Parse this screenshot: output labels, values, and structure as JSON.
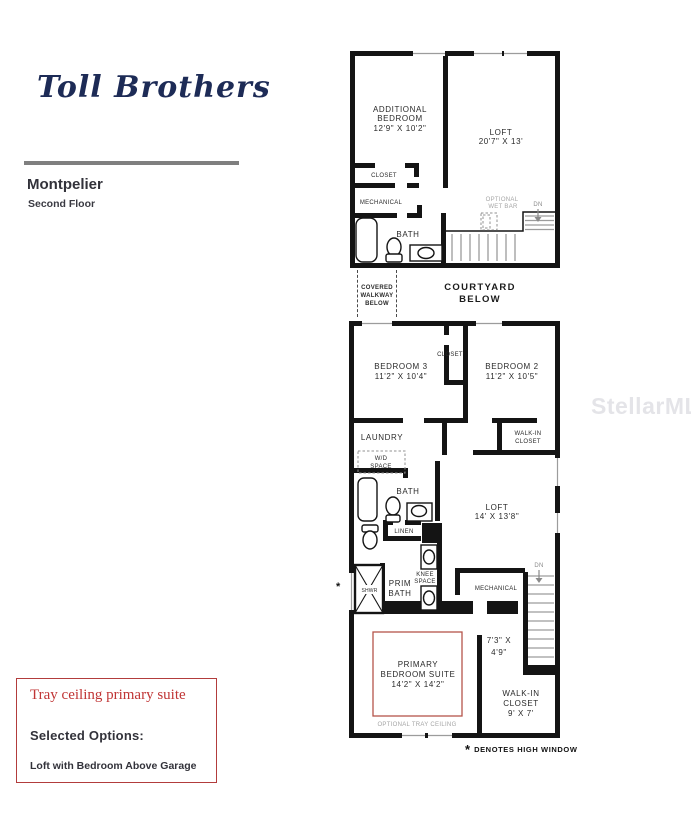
{
  "colors": {
    "logo_navy": "#1d2b56",
    "rule_gray": "#7f7f7f",
    "plan_ink": "#141414",
    "optional_gray": "#a5a5a5",
    "tray_red": "#b5544a",
    "box_border_red": "#b23c3c",
    "box_text_red": "#c03535",
    "watermark_gray": "#b8b8c2"
  },
  "brand": {
    "logo_text": "Toll Brothers"
  },
  "header": {
    "plan_name": "Montpelier",
    "floor_label": "Second Floor"
  },
  "watermark": {
    "text": "StellarMLS"
  },
  "upper_plan": {
    "additional_bedroom_1": "ADDITIONAL",
    "additional_bedroom_2": "BEDROOM",
    "additional_bedroom_dims": "12'9\" X 10'2\"",
    "loft": "LOFT",
    "loft_dims": "20'7\" X 13'",
    "closet": "CLOSET",
    "mechanical": "MECHANICAL",
    "bath": "BATH",
    "wet_bar_1": "OPTIONAL",
    "wet_bar_2": "WET BAR",
    "dn": "DN"
  },
  "courtyard": {
    "covered_1": "COVERED",
    "covered_2": "WALKWAY",
    "covered_3": "BELOW",
    "courtyard_1": "COURTYARD",
    "courtyard_2": "BELOW"
  },
  "lower_plan": {
    "bedroom3": "BEDROOM 3",
    "bedroom3_dims": "11'2\" X 10'4\"",
    "closet": "CLOSET",
    "bedroom2": "BEDROOM 2",
    "bedroom2_dims": "11'2\" X 10'5\"",
    "laundry": "LAUNDRY",
    "wd_1": "W/D",
    "wd_2": "SPACE",
    "walkin_top_1": "WALK-IN",
    "walkin_top_2": "CLOSET",
    "bath": "BATH",
    "linen": "LINEN",
    "loft": "LOFT",
    "loft_dims": "14' X 13'8\"",
    "knee_1": "KNEE",
    "knee_2": "SPACE",
    "prim_1": "PRIM",
    "prim_2": "BATH",
    "shwr": "SHWR",
    "mechanical": "MECHANICAL",
    "dn": "DN",
    "stair_hall_dims_1": "7'3\" X",
    "stair_hall_dims_2": "4'9\"",
    "primary_1": "PRIMARY",
    "primary_2": "BEDROOM SUITE",
    "primary_dims": "14'2\" X 14'2\"",
    "tray_note": "OPTIONAL TRAY CEILING",
    "high_window_star": "*"
  },
  "footnote": {
    "star": "*",
    "text": "DENOTES HIGH WINDOW"
  },
  "lower_walkin": {
    "l1": "WALK-IN",
    "l2": "CLOSET",
    "dims": "9' X 7'"
  },
  "options_box": {
    "highlight": "Tray ceiling primary suite",
    "heading": "Selected Options:",
    "option": "Loft with Bedroom Above Garage"
  }
}
